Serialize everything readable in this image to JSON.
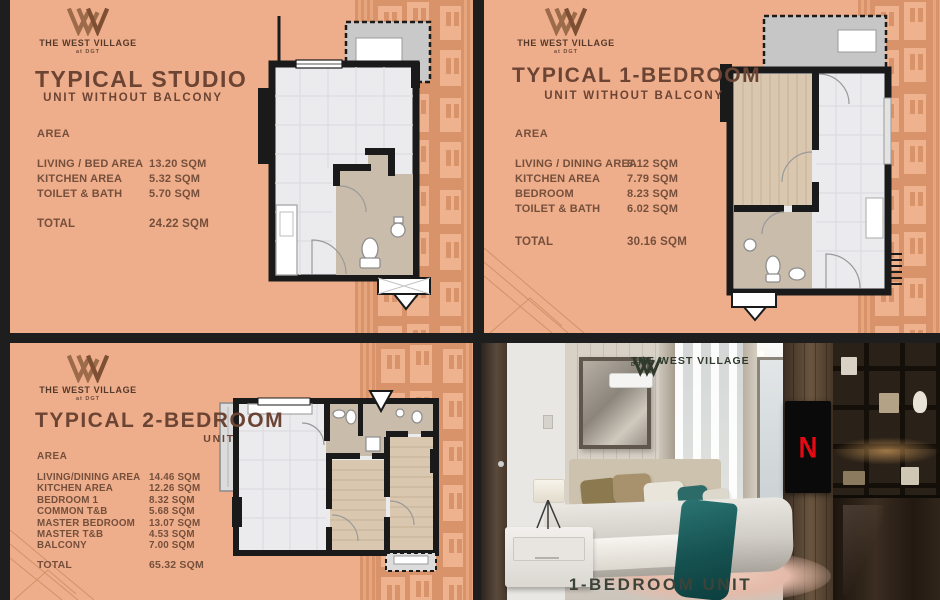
{
  "brand": {
    "name": "THE WEST VILLAGE",
    "tagline": "at DGT"
  },
  "colors": {
    "panel_background": "#EFAE8B",
    "pattern_terracotta": "#D8936A",
    "heading_brown": "#6B4434",
    "body_brown": "#744F3C",
    "plan_wall_black": "#1A1A1A",
    "photo_logo_green": "#2F3A2C",
    "tv_accent_red": "#E50914"
  },
  "panels": {
    "studio": {
      "title": "TYPICAL STUDIO",
      "subtitle": "UNIT WITHOUT BALCONY",
      "area_label": "AREA",
      "rows": [
        {
          "label": "LIVING / BED AREA",
          "value": "13.20 SQM"
        },
        {
          "label": "KITCHEN AREA",
          "value": "5.32 SQM"
        },
        {
          "label": "TOILET & BATH",
          "value": "5.70 SQM"
        }
      ],
      "total_label": "TOTAL",
      "total_value": "24.22 SQM"
    },
    "one_bedroom": {
      "title": "TYPICAL 1-BEDROOM",
      "subtitle": "UNIT WITHOUT BALCONY",
      "area_label": "AREA",
      "rows": [
        {
          "label": "LIVING / DINING AREA",
          "value": "8.12 SQM"
        },
        {
          "label": "KITCHEN AREA",
          "value": "7.79 SQM"
        },
        {
          "label": "BEDROOM",
          "value": "8.23 SQM"
        },
        {
          "label": "TOILET & BATH",
          "value": "6.02 SQM"
        }
      ],
      "total_label": "TOTAL",
      "total_value": "30.16 SQM"
    },
    "two_bedroom": {
      "title": "TYPICAL 2-BEDROOM",
      "subtitle": "UNIT",
      "area_label": "AREA",
      "rows": [
        {
          "label": "LIVING/DINING AREA",
          "value": "14.46 SQM"
        },
        {
          "label": "KITCHEN AREA",
          "value": "12.26 SQM"
        },
        {
          "label": "BEDROOM 1",
          "value": "8.32 SQM"
        },
        {
          "label": "COMMON T&B",
          "value": "5.68 SQM"
        },
        {
          "label": "MASTER BEDROOM",
          "value": "13.07 SQM"
        },
        {
          "label": "MASTER T&B",
          "value": "4.53 SQM"
        },
        {
          "label": "BALCONY",
          "value": "7.00 SQM"
        }
      ],
      "total_label": "TOTAL",
      "total_value": "65.32 SQM"
    },
    "photo": {
      "caption": "1-BEDROOM UNIT",
      "tv_label": "N"
    }
  }
}
